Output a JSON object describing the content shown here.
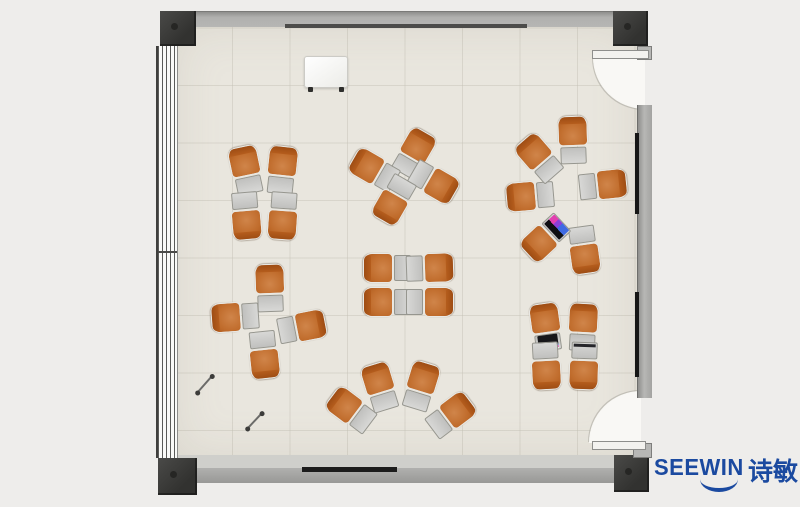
{
  "brand": {
    "name": "SEEWIN",
    "cjk": "诗敏",
    "color": "#1b4aa0"
  },
  "room": {
    "floor_color": "#e9e6de",
    "wall_color": "#a9a9a7",
    "post_color": "#3a3a38",
    "chair_color": "#c06c2c",
    "desk_color": "#c9c9c7",
    "doors": 2,
    "window_wall": "left"
  },
  "furniture": {
    "unit_type": "desk-chair-combo",
    "unit_count": 30,
    "clusters": [
      {
        "name": "grid-2x2-top-left",
        "units": [
          {
            "x": 246,
            "y": 170,
            "r": 168
          },
          {
            "x": 282,
            "y": 170,
            "r": 186
          },
          {
            "x": 246,
            "y": 216,
            "r": 355
          },
          {
            "x": 283,
            "y": 216,
            "r": 4
          }
        ]
      },
      {
        "name": "pinwheel-top-center",
        "units": [
          {
            "x": 414,
            "y": 153,
            "r": 210
          },
          {
            "x": 374,
            "y": 170,
            "r": 120
          },
          {
            "x": 434,
            "y": 182,
            "r": 300
          },
          {
            "x": 394,
            "y": 200,
            "r": 30
          }
        ]
      },
      {
        "name": "circle-right",
        "units": [
          {
            "x": 573,
            "y": 140,
            "r": 178
          },
          {
            "x": 603,
            "y": 185,
            "r": 264
          },
          {
            "x": 584,
            "y": 250,
            "r": 352
          },
          {
            "x": 545,
            "y": 238,
            "r": 47,
            "item": "screen"
          },
          {
            "x": 530,
            "y": 196,
            "r": 85
          },
          {
            "x": 539,
            "y": 158,
            "r": 139
          }
        ]
      },
      {
        "name": "cross-middle-left",
        "units": [
          {
            "x": 270,
            "y": 288,
            "r": 178
          },
          {
            "x": 235,
            "y": 317,
            "r": 86
          },
          {
            "x": 302,
            "y": 327,
            "r": 259
          },
          {
            "x": 264,
            "y": 355,
            "r": 354
          }
        ]
      },
      {
        "name": "grid-2x2-center",
        "units": [
          {
            "x": 387,
            "y": 268,
            "r": 90
          },
          {
            "x": 387,
            "y": 302,
            "r": 90
          },
          {
            "x": 430,
            "y": 268,
            "r": 268
          },
          {
            "x": 430,
            "y": 302,
            "r": 270
          }
        ]
      },
      {
        "name": "fan-bottom-center",
        "units": [
          {
            "x": 351,
            "y": 410,
            "r": 127
          },
          {
            "x": 380,
            "y": 387,
            "r": 163
          },
          {
            "x": 421,
            "y": 386,
            "r": 197
          },
          {
            "x": 451,
            "y": 415,
            "r": 233
          }
        ]
      },
      {
        "name": "grid-2x2-bottom-right",
        "units": [
          {
            "x": 546,
            "y": 327,
            "r": 172,
            "item": "laptop"
          },
          {
            "x": 583,
            "y": 327,
            "r": 183
          },
          {
            "x": 546,
            "y": 366,
            "r": 357
          },
          {
            "x": 584,
            "y": 366,
            "r": 2,
            "item": "bar"
          }
        ]
      }
    ],
    "objects": [
      {
        "type": "whiteboard",
        "x": 304,
        "y": 56,
        "w": 42,
        "h": 30
      },
      {
        "type": "pen",
        "x1": 197,
        "y1": 392,
        "x2": 212,
        "y2": 375
      },
      {
        "type": "pen",
        "x1": 247,
        "y1": 428,
        "x2": 262,
        "y2": 412
      }
    ]
  }
}
